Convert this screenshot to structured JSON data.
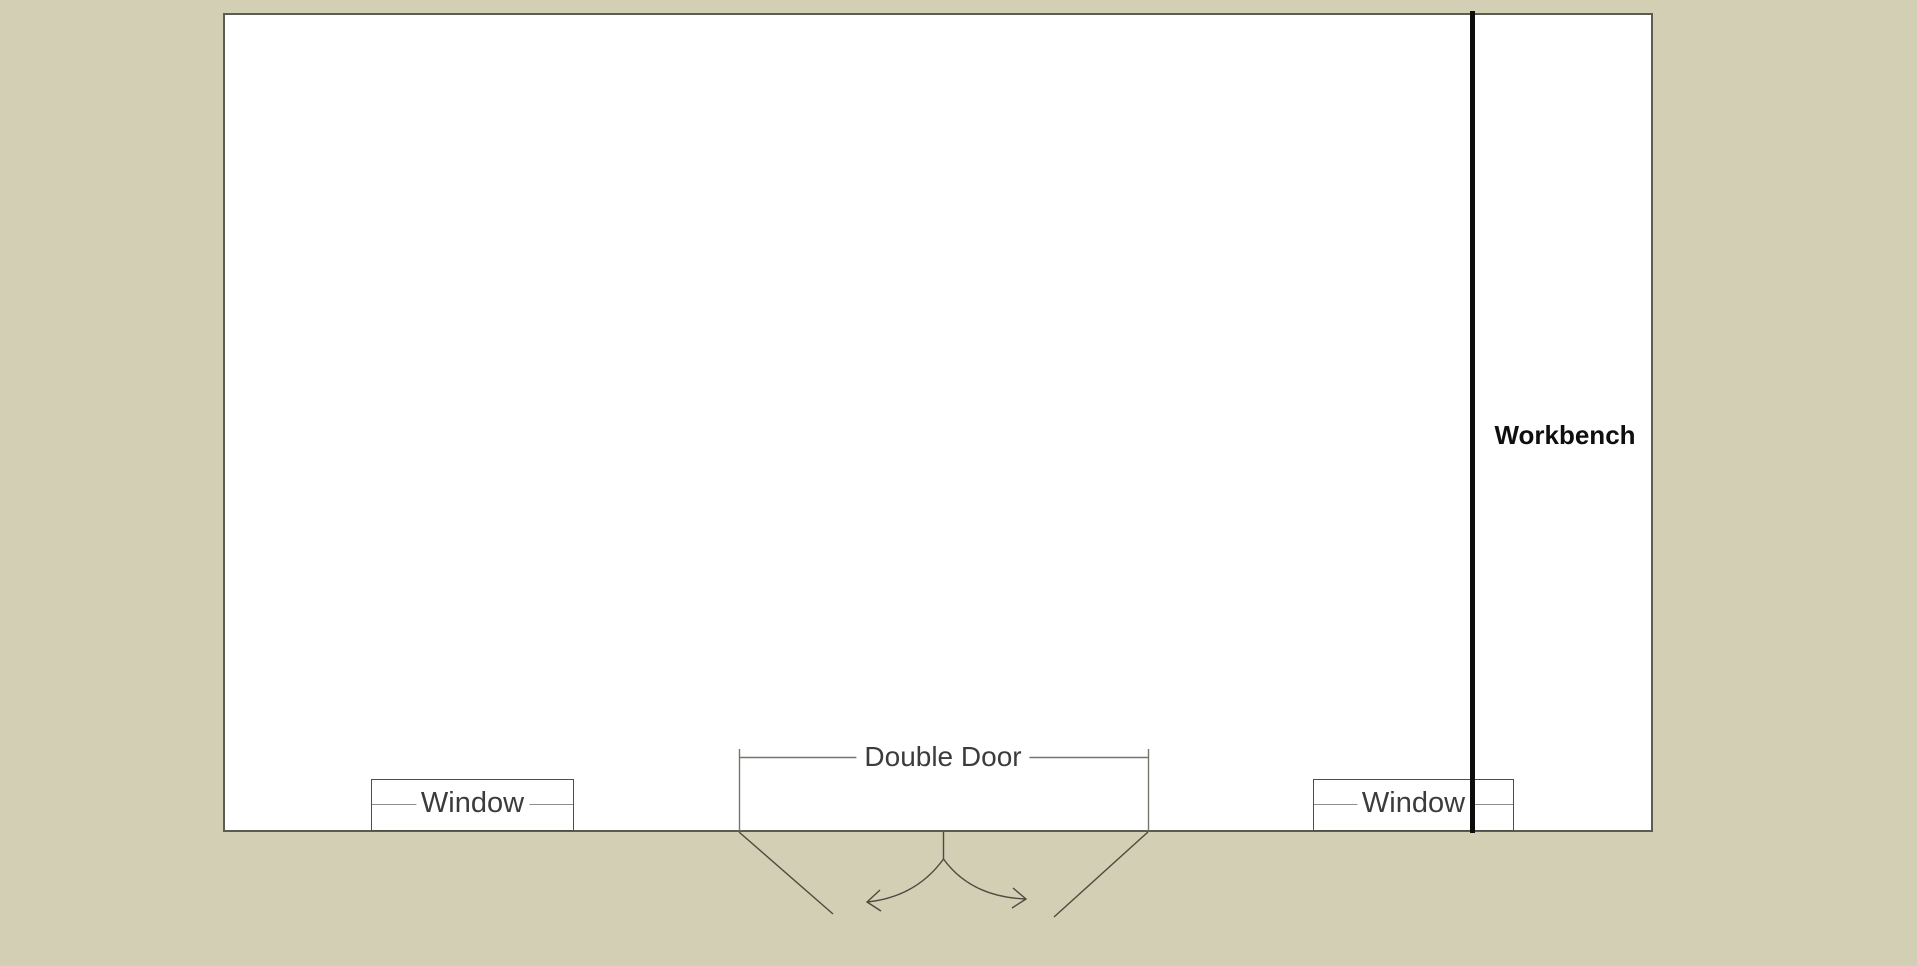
{
  "floorplan": {
    "workbench": {
      "label": "Workbench"
    },
    "double_door": {
      "label": "Double Door"
    },
    "windows": [
      {
        "label": "Window"
      },
      {
        "label": "Window"
      }
    ]
  },
  "colors": {
    "canvas_background": "#d2cfb4",
    "room_fill": "#ffffff",
    "wall_outline": "#5c5c52",
    "divider": "#0d0d0d",
    "fixture_outline": "#4f4f47",
    "window_midline": "#8f8f89",
    "annotation_line": "#75756d",
    "door_line": "#4b4b41",
    "label_text": "#3c3c3c",
    "workbench_text": "#0f0f0f"
  }
}
